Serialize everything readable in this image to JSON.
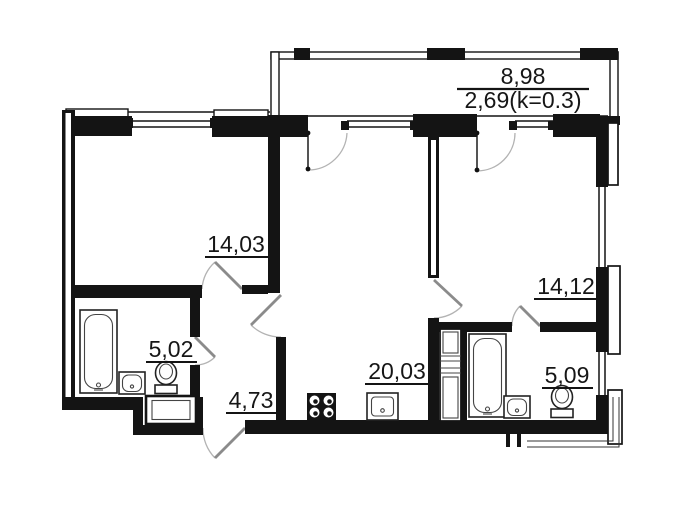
{
  "plan": {
    "type": "apartment-floor-plan",
    "balcony": {
      "area_total": "8,98",
      "area_reduced": "2,69(k=0.3)"
    },
    "rooms": [
      {
        "id": "bedroom-left",
        "area": "14,03"
      },
      {
        "id": "bathroom-left",
        "area": "5,02"
      },
      {
        "id": "hallway",
        "area": "4,73"
      },
      {
        "id": "kitchen-living",
        "area": "20,03"
      },
      {
        "id": "bedroom-right",
        "area": "14,12"
      },
      {
        "id": "bathroom-right",
        "area": "5,09"
      }
    ],
    "colors": {
      "wall": "#141414",
      "door_leaf": "#8b8b8b",
      "door_arc": "#b3b3b3",
      "text": "#161616",
      "background": "#ffffff"
    }
  }
}
